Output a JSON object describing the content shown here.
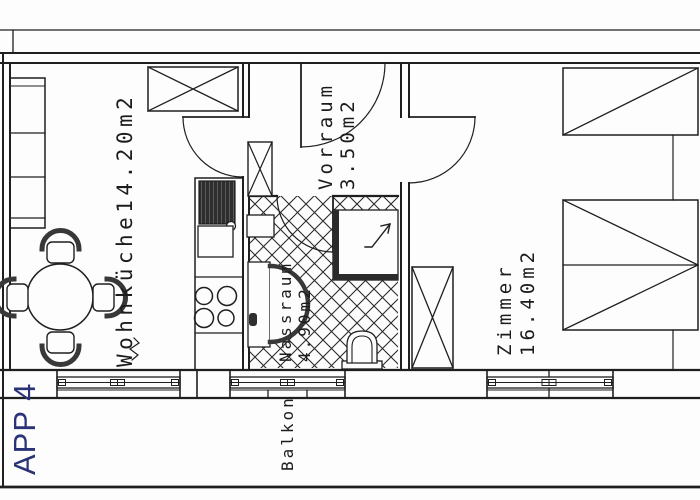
{
  "plan": {
    "title": "APP 4",
    "labels": {
      "wohnkueche": {
        "text": "Wohnküche14.20m2"
      },
      "vorraum": {
        "name": "Vorraum",
        "area": "3.50m2"
      },
      "nassraum": {
        "name": "Nassraum",
        "area": "4.90m2"
      },
      "zimmer": {
        "name": "Zimmer",
        "area": "16.40m2"
      },
      "balkon": {
        "text": "Balkon"
      }
    },
    "colors": {
      "line": "#1f1f1f",
      "furniture_accent": "#383838",
      "label": "#1c1c1c",
      "title": "#2a3376",
      "background": "#fdfdfd"
    }
  }
}
